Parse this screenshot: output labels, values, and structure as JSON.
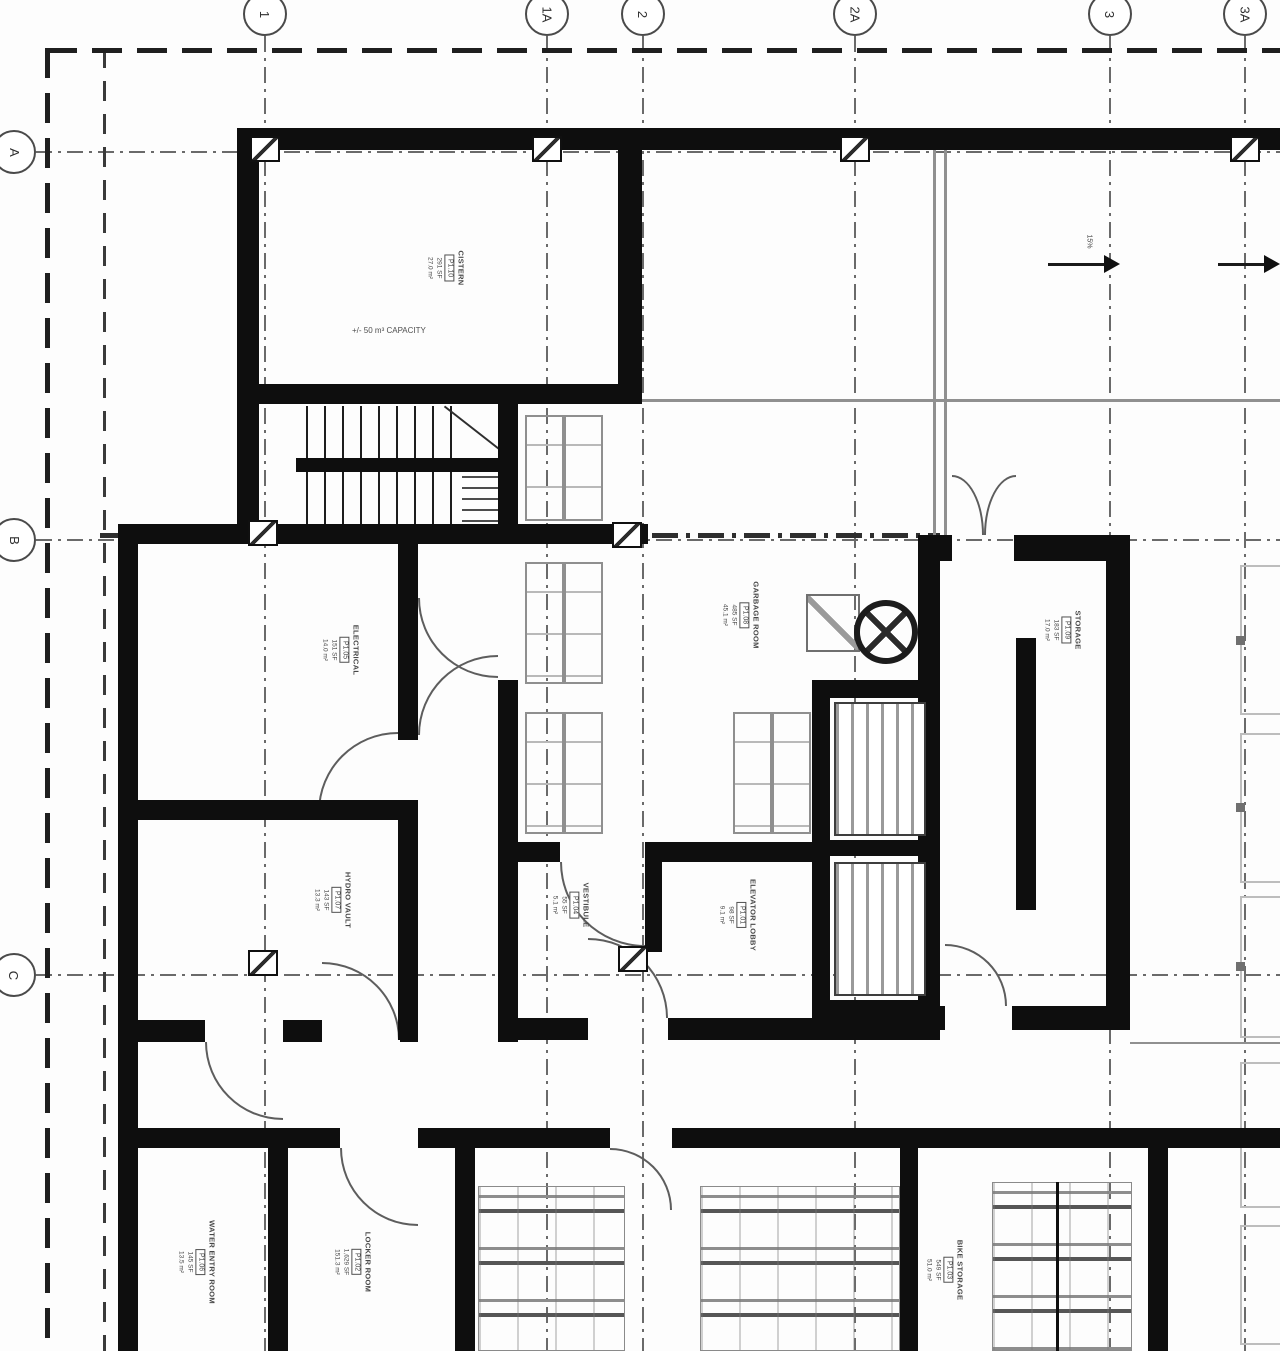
{
  "drawing": {
    "grid_columns": [
      {
        "label": "1"
      },
      {
        "label": "1A"
      },
      {
        "label": "2"
      },
      {
        "label": "2A"
      },
      {
        "label": "3"
      },
      {
        "label": "3A"
      }
    ],
    "grid_rows": [
      {
        "label": "A"
      },
      {
        "label": "B"
      },
      {
        "label": "C"
      }
    ],
    "rooms": {
      "cistern": {
        "name": "CISTERN",
        "num": "P1.10",
        "area_sf": "291 SF",
        "area_m2": "27.0 m²"
      },
      "electrical": {
        "name": "ELECTRICAL",
        "num": "P1.05",
        "area_sf": "151 SF",
        "area_m2": "14.0 m²"
      },
      "hydro": {
        "name": "HYDRO VAULT",
        "num": "P1.07",
        "area_sf": "143 SF",
        "area_m2": "13.3 m²"
      },
      "vestibule": {
        "name": "VESTIBULE",
        "num": "P1.04",
        "area_sf": "55 SF",
        "area_m2": "5.1 m²"
      },
      "lobby": {
        "name": "ELEVATOR LOBBY",
        "num": "P1.01",
        "area_sf": "98 SF",
        "area_m2": "9.1 m²"
      },
      "garbage": {
        "name": "GARBAGE ROOM",
        "num": "P1.08",
        "area_sf": "485 SF",
        "area_m2": "45.1 m²"
      },
      "storage": {
        "name": "STORAGE",
        "num": "P1.09",
        "area_sf": "183 SF",
        "area_m2": "17.0 m²"
      },
      "water": {
        "name": "WATER ENTRY ROOM",
        "num": "P1.06",
        "area_sf": "145 SF",
        "area_m2": "13.5 m²"
      },
      "locker": {
        "name": "LOCKER ROOM",
        "num": "P1.02",
        "area_sf": "1,629 SF",
        "area_m2": "151.3 m²"
      },
      "bike": {
        "name": "BIKE STORAGE",
        "num": "P1.03",
        "area_sf": "549 SF",
        "area_m2": "51.0 m²"
      }
    },
    "annotations": {
      "cistern_capacity": "+/- 50 m³ CAPACITY",
      "ramp_slope": "15%"
    },
    "colors": {
      "wall": "#0e0e0e",
      "grid_line": "#6a6a6a",
      "property_line": "#1f1f1f",
      "text": "#474747",
      "light_line": "#bdbdbd",
      "paper": "#fdfdfd"
    }
  }
}
